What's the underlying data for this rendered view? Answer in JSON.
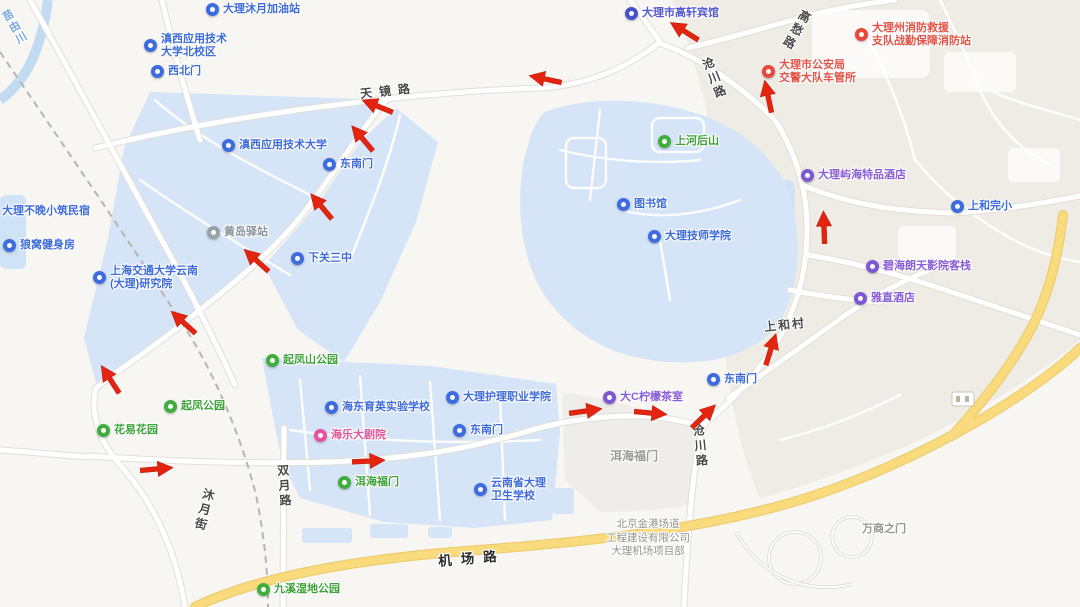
{
  "canvas": {
    "width": 1080,
    "height": 607
  },
  "colors": {
    "land": "#f7f6f3",
    "hills": "#efece5",
    "campus_area": "#d5e4f6",
    "water": "#cfe2f6",
    "plaza": "#eeede9",
    "road_fill": "#ffffff",
    "road_casing": "#e2dfda",
    "yellow_road": "#f9da7c",
    "railway": "#b8b5b0",
    "route_arrow": "#e3250f",
    "poi_blue": "#3d6be0",
    "poi_green": "#3fae3c",
    "poi_purple": "#7e57d2",
    "poi_red": "#e8473c",
    "poi_pink": "#e8519e",
    "poi_gray": "#98a1a8"
  },
  "pois": [
    {
      "name": "gas-station-pin",
      "icon": "gas-station-icon",
      "pin": "blue",
      "has_pin": true,
      "x": 213,
      "y": 10,
      "lines": [
        "大理沐月加油站"
      ]
    },
    {
      "name": "campus-pin",
      "icon": "school-icon",
      "pin": "blue",
      "has_pin": true,
      "x": 151,
      "y": 40,
      "lines": [
        "滇西应用技术",
        "大学北校区"
      ]
    },
    {
      "name": "gate-pin",
      "icon": "gate-icon",
      "pin": "blue",
      "has_pin": true,
      "x": 158,
      "y": 72,
      "lines": [
        "西北门"
      ]
    },
    {
      "name": "university-pin",
      "icon": "school-icon",
      "pin": "blue",
      "has_pin": true,
      "x": 229,
      "y": 146,
      "lines": [
        "滇西应用技术大学"
      ]
    },
    {
      "name": "gate-pin",
      "icon": "gate-icon",
      "pin": "blue",
      "has_pin": true,
      "x": 330,
      "y": 165,
      "lines": [
        "东南门"
      ]
    },
    {
      "name": "station-pin",
      "icon": "transit-station-icon",
      "pin": "gray",
      "has_pin": true,
      "x": 214,
      "y": 233,
      "lines": [
        "黄岛驿站"
      ]
    },
    {
      "name": "school-pin",
      "icon": "school-icon",
      "pin": "blue",
      "has_pin": true,
      "x": 298,
      "y": 259,
      "lines": [
        "下关三中"
      ]
    },
    {
      "name": "research-institute-pin",
      "icon": "school-icon",
      "pin": "blue",
      "has_pin": true,
      "x": 100,
      "y": 272,
      "lines": [
        "上海交通大学云南",
        "(大理)研究院"
      ]
    },
    {
      "name": "gym-pin",
      "icon": "gym-icon",
      "pin": "blue",
      "has_pin": true,
      "x": 10,
      "y": 246,
      "lines": [
        "狼窝健身房"
      ]
    },
    {
      "name": "homestay-label",
      "icon": "hotel-icon",
      "pin": "blue",
      "has_pin": false,
      "x": 2,
      "y": 212,
      "lines": [
        "大理不晚小筑民宿"
      ]
    },
    {
      "name": "hotel-pin",
      "icon": "hotel-icon",
      "pin": "indigo",
      "has_pin": true,
      "x": 632,
      "y": 14,
      "lines": [
        "大理市高轩宾馆"
      ]
    },
    {
      "name": "mountain-pin",
      "icon": "mountain-icon",
      "pin": "green",
      "has_pin": true,
      "x": 665,
      "y": 142,
      "lines": [
        "上河后山"
      ]
    },
    {
      "name": "library-pin",
      "icon": "library-icon",
      "pin": "blue",
      "has_pin": true,
      "x": 624,
      "y": 205,
      "lines": [
        "图书馆"
      ]
    },
    {
      "name": "college-pin",
      "icon": "school-icon",
      "pin": "blue",
      "has_pin": true,
      "x": 655,
      "y": 237,
      "lines": [
        "大理技师学院"
      ]
    },
    {
      "name": "hotel-pin",
      "icon": "hotel-icon",
      "pin": "purple",
      "has_pin": true,
      "x": 808,
      "y": 176,
      "lines": [
        "大理屿海特品酒店"
      ]
    },
    {
      "name": "school-pin",
      "icon": "school-icon",
      "pin": "blue",
      "has_pin": true,
      "x": 958,
      "y": 207,
      "lines": [
        "上和完小"
      ]
    },
    {
      "name": "inn-pin",
      "icon": "hotel-icon",
      "pin": "purple",
      "has_pin": true,
      "x": 873,
      "y": 267,
      "lines": [
        "碧海朗天影院客栈"
      ]
    },
    {
      "name": "hotel-pin",
      "icon": "hotel-icon",
      "pin": "purple",
      "has_pin": true,
      "x": 861,
      "y": 299,
      "lines": [
        "雅直酒店"
      ]
    },
    {
      "name": "gate-pin",
      "icon": "gate-icon",
      "pin": "blue",
      "has_pin": true,
      "x": 714,
      "y": 380,
      "lines": [
        "东南门"
      ]
    },
    {
      "name": "tea-shop-pin",
      "icon": "cafe-icon",
      "pin": "purple",
      "has_pin": true,
      "x": 610,
      "y": 398,
      "lines": [
        "大C柠檬茶室"
      ]
    },
    {
      "name": "college-pin",
      "icon": "school-icon",
      "pin": "blue",
      "has_pin": true,
      "x": 453,
      "y": 398,
      "lines": [
        "大理护理职业学院"
      ]
    },
    {
      "name": "gate-pin",
      "icon": "gate-icon",
      "pin": "blue",
      "has_pin": true,
      "x": 460,
      "y": 431,
      "lines": [
        "东南门"
      ]
    },
    {
      "name": "school-pin",
      "icon": "school-icon",
      "pin": "blue",
      "has_pin": true,
      "x": 332,
      "y": 408,
      "lines": [
        "海东育英实验学校"
      ]
    },
    {
      "name": "theater-pin",
      "icon": "theater-icon",
      "pin": "pink",
      "has_pin": true,
      "x": 321,
      "y": 436,
      "lines": [
        "海乐大剧院"
      ]
    },
    {
      "name": "school-pin",
      "icon": "school-icon",
      "pin": "blue",
      "has_pin": true,
      "x": 481,
      "y": 484,
      "lines": [
        "云南省大理",
        "卫生学校"
      ]
    },
    {
      "name": "park-pin",
      "icon": "park-icon",
      "pin": "green",
      "has_pin": true,
      "x": 273,
      "y": 361,
      "lines": [
        "起凤山公园"
      ]
    },
    {
      "name": "park-pin",
      "icon": "park-icon",
      "pin": "green",
      "has_pin": true,
      "x": 171,
      "y": 407,
      "lines": [
        "起凤公园"
      ]
    },
    {
      "name": "park-pin",
      "icon": "park-icon",
      "pin": "green",
      "has_pin": true,
      "x": 104,
      "y": 431,
      "lines": [
        "花易花园"
      ]
    },
    {
      "name": "park-pin",
      "icon": "park-icon",
      "pin": "green",
      "has_pin": true,
      "x": 345,
      "y": 483,
      "lines": [
        "洱海福门"
      ]
    },
    {
      "name": "park-pin",
      "icon": "park-icon",
      "pin": "green",
      "has_pin": true,
      "x": 264,
      "y": 590,
      "lines": [
        "九溪湿地公园"
      ]
    },
    {
      "name": "fire-station-pin",
      "icon": "fire-station-icon",
      "pin": "red",
      "has_pin": true,
      "x": 862,
      "y": 29,
      "lines": [
        "大理州消防救援",
        "支队战勤保障消防站"
      ]
    },
    {
      "name": "police-pin",
      "icon": "police-icon",
      "pin": "red",
      "has_pin": true,
      "x": 769,
      "y": 66,
      "lines": [
        "大理市公安局",
        "交警大队车管所"
      ]
    }
  ],
  "labels": [
    {
      "name": "road-label",
      "cls": "road",
      "text": "天镜路",
      "x": 360,
      "y": 82,
      "rot": -6,
      "ls": 7
    },
    {
      "name": "road-label",
      "cls": "roadv",
      "text": "沧川路",
      "x": 706,
      "y": 56,
      "rot": -22
    },
    {
      "name": "road-label",
      "cls": "roadv",
      "text": "沧川路",
      "x": 692,
      "y": 424,
      "rot": -6
    },
    {
      "name": "road-label",
      "cls": "roadv",
      "text": "高愁路",
      "x": 788,
      "y": 8,
      "rot": 30
    },
    {
      "name": "road-label",
      "cls": "roadv",
      "text": "双月路",
      "x": 276,
      "y": 464,
      "rot": -4
    },
    {
      "name": "road-label",
      "cls": "roadv",
      "text": "沐月街",
      "x": 196,
      "y": 488,
      "rot": 14
    },
    {
      "name": "river-label",
      "cls": "waterv",
      "text": "苗由川",
      "x": 6,
      "y": 8,
      "rot": -30
    },
    {
      "name": "road-label",
      "cls": "roadbig",
      "text": "机场路",
      "x": 438,
      "y": 547,
      "rot": -5,
      "ls": 9
    },
    {
      "name": "village-label",
      "cls": "district",
      "text": "上和村",
      "x": 764,
      "y": 316,
      "rot": -6,
      "ls": 2
    },
    {
      "name": "area-label",
      "cls": "area",
      "text": "洱海福门",
      "x": 610,
      "y": 447
    },
    {
      "name": "company-label",
      "cls": "areasm",
      "lines": [
        "北京金港场道",
        "工程建设有限公司",
        "大理机场项目部"
      ],
      "x": 648,
      "y": 518
    },
    {
      "name": "area-label",
      "cls": "area2",
      "text": "万商之门",
      "x": 862,
      "y": 520
    }
  ],
  "arrows": [
    {
      "x": 545,
      "y": 79,
      "rot": 192
    },
    {
      "x": 684,
      "y": 31,
      "rot": 212
    },
    {
      "x": 768,
      "y": 96,
      "rot": 258
    },
    {
      "x": 824,
      "y": 227,
      "rot": 268
    },
    {
      "x": 771,
      "y": 349,
      "rot": 288
    },
    {
      "x": 704,
      "y": 416,
      "rot": 316
    },
    {
      "x": 651,
      "y": 413,
      "rot": 5
    },
    {
      "x": 586,
      "y": 411,
      "rot": 352
    },
    {
      "x": 369,
      "y": 461,
      "rot": 357
    },
    {
      "x": 157,
      "y": 469,
      "rot": 355
    },
    {
      "x": 110,
      "y": 379,
      "rot": 237
    },
    {
      "x": 183,
      "y": 322,
      "rot": 222
    },
    {
      "x": 256,
      "y": 260,
      "rot": 222
    },
    {
      "x": 321,
      "y": 206,
      "rot": 230
    },
    {
      "x": 362,
      "y": 138,
      "rot": 230
    },
    {
      "x": 377,
      "y": 106,
      "rot": 202
    }
  ]
}
